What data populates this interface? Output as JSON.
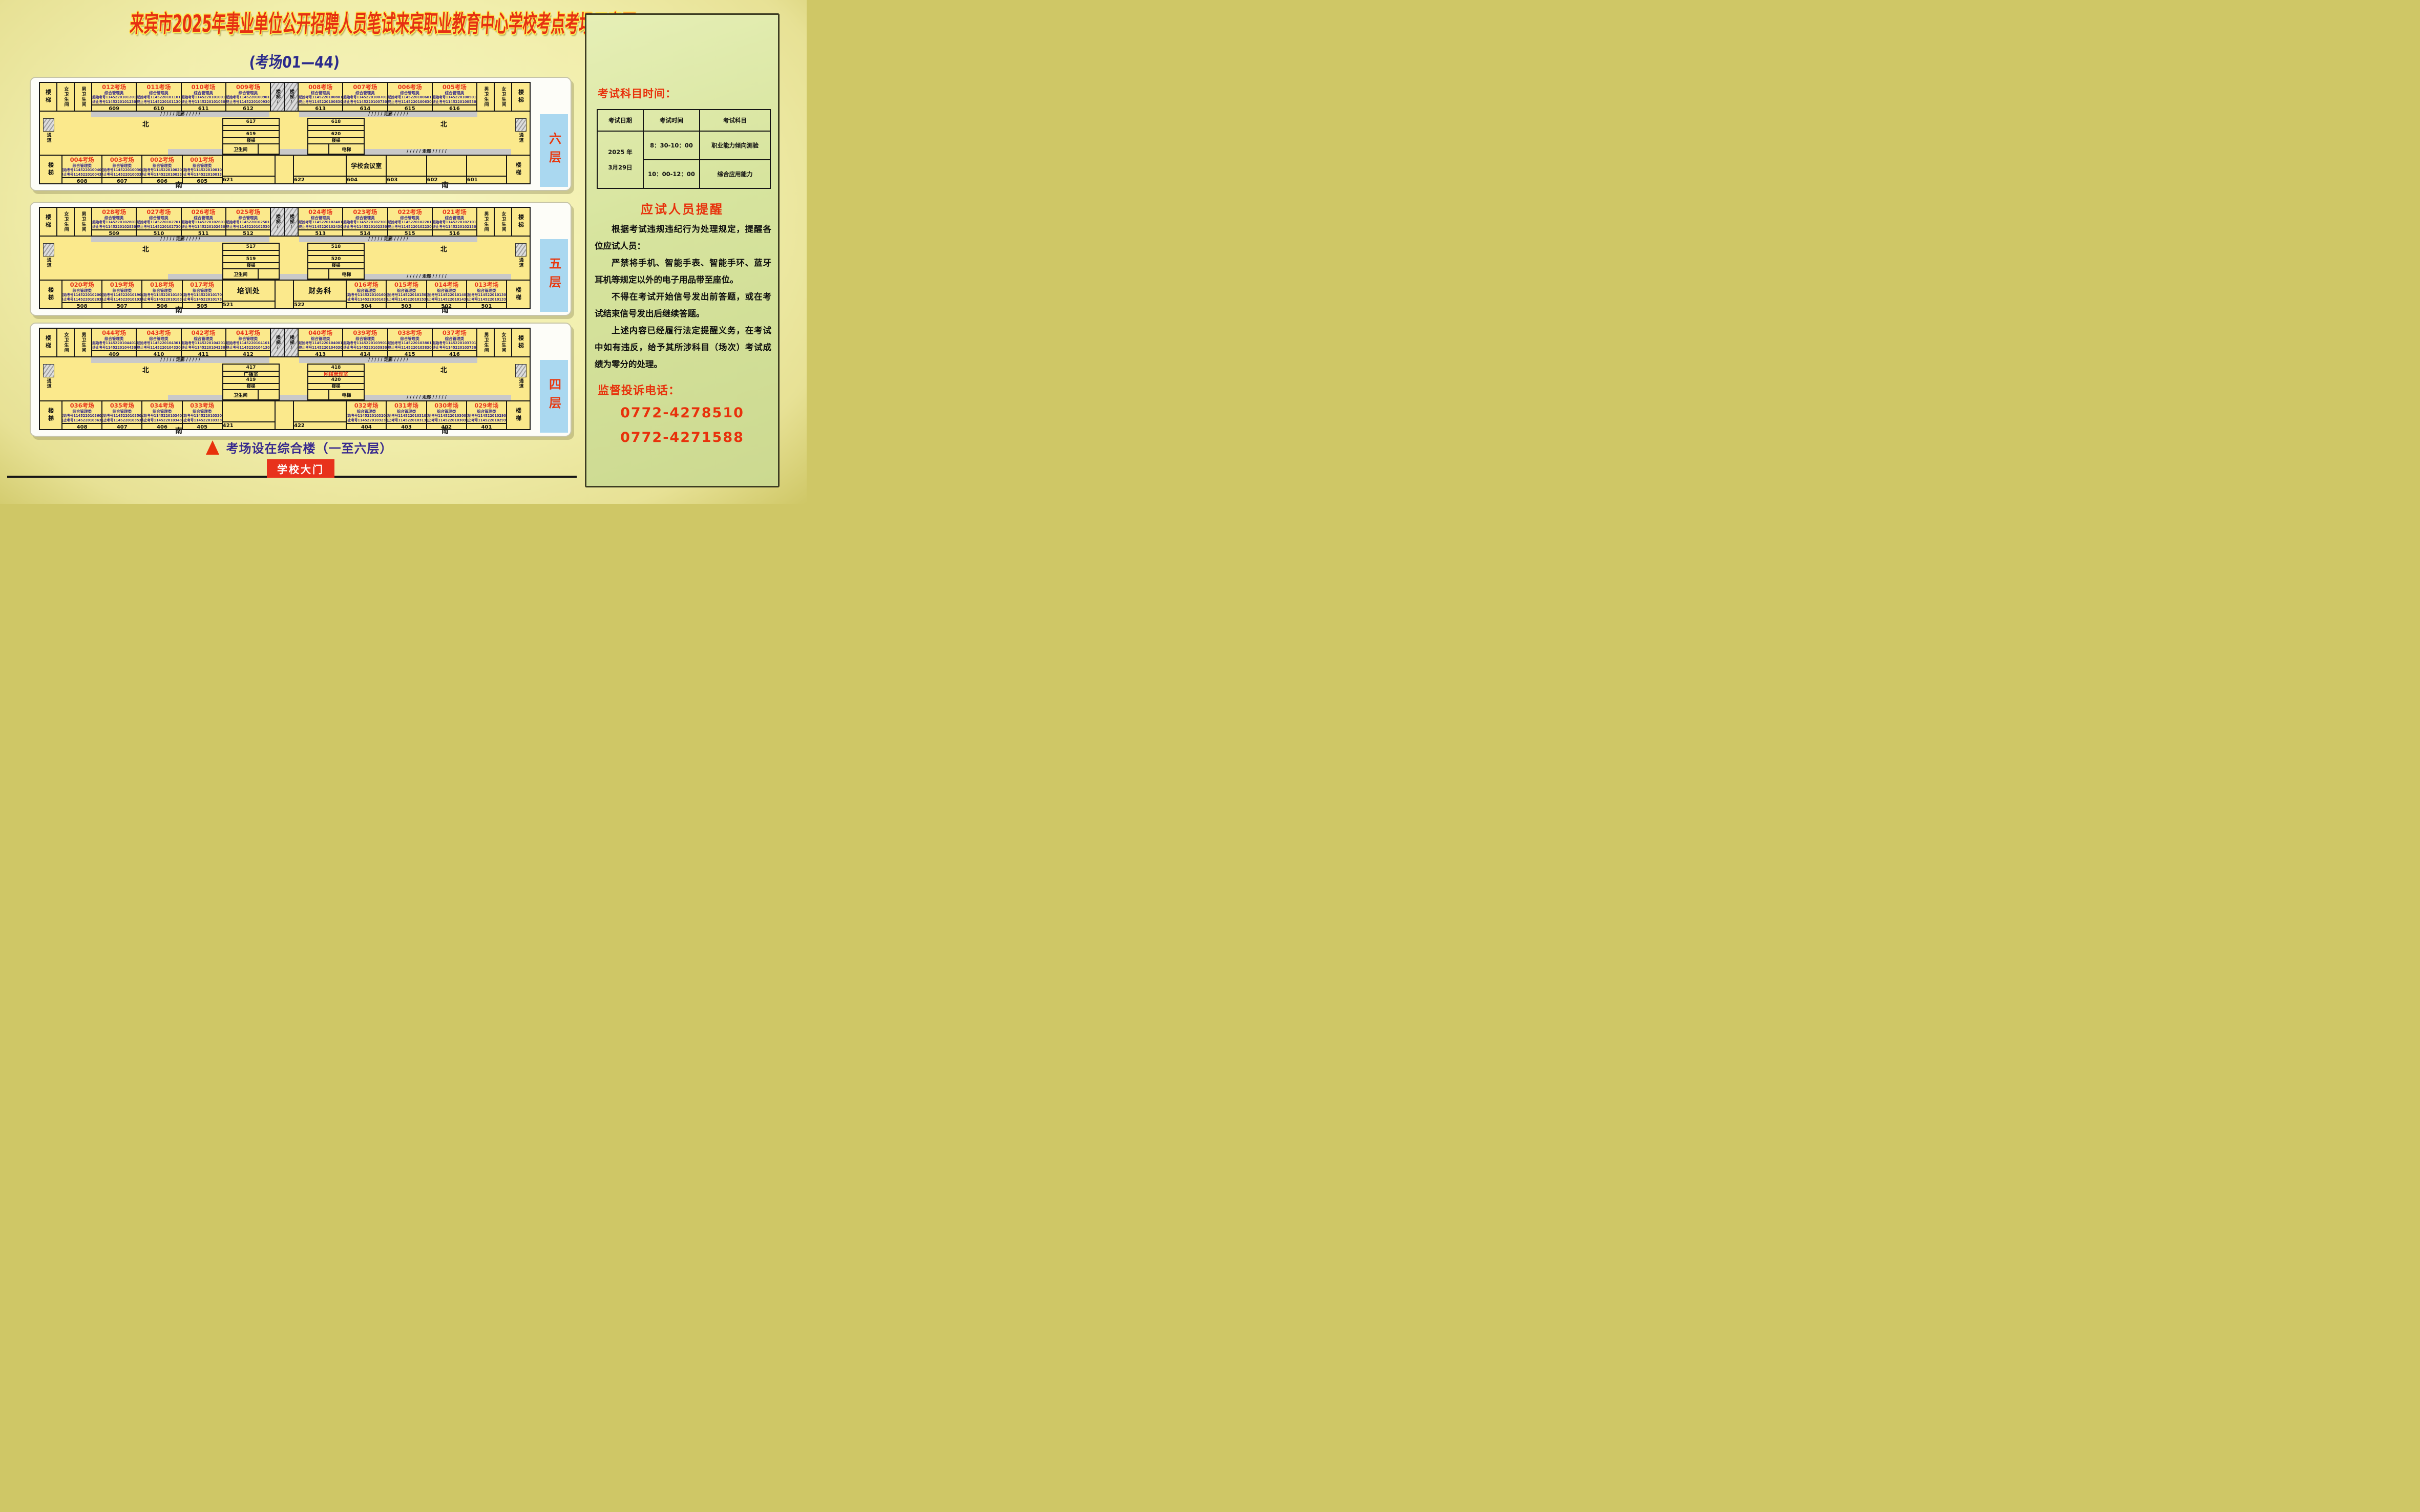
{
  "title": "来宾市2025年事业单位公开招聘人员笔试来宾职业教育中心学校考点考场示意图",
  "subtitle": "(考场01—44)",
  "labels": {
    "north": "北",
    "south": "南",
    "corridor": "/ / / / / 走廊 / / / / /",
    "passage": "通道",
    "stairs": "楼梯",
    "stairs_hatch": "楼梯/",
    "female_wc": "女卫生间",
    "male_wc": "男卫生间",
    "toilet": "卫生间",
    "elevator": "电梯",
    "category": "综合管理类",
    "start_prefix": "起始考号",
    "end_prefix": "终止考号"
  },
  "colors": {
    "accent_red": "#e8380f",
    "detail_purple": "#35298c",
    "room_yellow": "#fbe98c",
    "floor_bar_blue": "#aad8f0",
    "panel_green": "#d7e49e",
    "corridor_gray": "#c9c9c9",
    "gate_red": "#e8321c",
    "note_purple": "#37298e"
  },
  "floors": [
    {
      "bar": "六层",
      "top_left": [
        {
          "t": "012考场",
          "s": "1145220101201",
          "e": "1145220101230",
          "n": "609"
        },
        {
          "t": "011考场",
          "s": "1145220101101",
          "e": "1145220101130",
          "n": "610"
        },
        {
          "t": "010考场",
          "s": "1145220101001",
          "e": "1145220101030",
          "n": "611"
        },
        {
          "t": "009考场",
          "s": "1145220100901",
          "e": "1145220100930",
          "n": "612"
        }
      ],
      "top_right": [
        {
          "t": "008考场",
          "s": "1145220100801",
          "e": "1145220100830",
          "n": "613"
        },
        {
          "t": "007考场",
          "s": "1145220100701",
          "e": "1145220100730",
          "n": "614"
        },
        {
          "t": "006考场",
          "s": "1145220100601",
          "e": "1145220100630",
          "n": "615"
        },
        {
          "t": "005考场",
          "s": "1145220100501",
          "e": "1145220100530",
          "n": "616"
        }
      ],
      "bottom_left": [
        {
          "t": "004考场",
          "s": "1145220100401",
          "e": "1145220100430",
          "n": "608"
        },
        {
          "t": "003考场",
          "s": "1145220100301",
          "e": "1145220100330",
          "n": "607"
        },
        {
          "t": "002考场",
          "s": "1145220100201",
          "e": "1145220100230",
          "n": "606"
        },
        {
          "t": "001考场",
          "s": "1145220100101",
          "e": "1145220100130",
          "n": "605"
        }
      ],
      "wide_left": {
        "label": "",
        "n": "621"
      },
      "wide_right": {
        "label": "",
        "n": "622"
      },
      "bottom_right": [
        {
          "label": "学校会议室",
          "n": "604"
        },
        {
          "label": "",
          "n": "603"
        },
        {
          "label": "",
          "n": "602"
        },
        {
          "label": "",
          "n": "601"
        }
      ],
      "block_left": {
        "a": "617",
        "mid": "",
        "b": "619",
        "corner": "卫生间"
      },
      "block_right": {
        "a": "618",
        "mid": "",
        "b": "620",
        "corner": "电梯",
        "mid_red": false
      }
    },
    {
      "bar": "五层",
      "top_left": [
        {
          "t": "028考场",
          "s": "1145220102801",
          "e": "1145220102830",
          "n": "509"
        },
        {
          "t": "027考场",
          "s": "1145220102701",
          "e": "1145220102730",
          "n": "510"
        },
        {
          "t": "026考场",
          "s": "1145220102601",
          "e": "1145220102630",
          "n": "511"
        },
        {
          "t": "025考场",
          "s": "1145220102501",
          "e": "1145220102530",
          "n": "512"
        }
      ],
      "top_right": [
        {
          "t": "024考场",
          "s": "1145220102401",
          "e": "1145220102430",
          "n": "513"
        },
        {
          "t": "023考场",
          "s": "1145220102301",
          "e": "1145220102330",
          "n": "514"
        },
        {
          "t": "022考场",
          "s": "1145220102201",
          "e": "1145220102230",
          "n": "515"
        },
        {
          "t": "021考场",
          "s": "1145220102101",
          "e": "1145220102130",
          "n": "516"
        }
      ],
      "bottom_left": [
        {
          "t": "020考场",
          "s": "1145220102001",
          "e": "1145220102030",
          "n": "508"
        },
        {
          "t": "019考场",
          "s": "1145220101901",
          "e": "1145220101930",
          "n": "507"
        },
        {
          "t": "018考场",
          "s": "1145220101801",
          "e": "1145220101830",
          "n": "506"
        },
        {
          "t": "017考场",
          "s": "1145220101701",
          "e": "1145220101730",
          "n": "505"
        }
      ],
      "wide_left": {
        "label": "培训处",
        "n": "521"
      },
      "wide_right": {
        "label": "财务科",
        "n": "522"
      },
      "bottom_right": [
        {
          "t": "016考场",
          "s": "1145220101601",
          "e": "1145220101630",
          "n": "504"
        },
        {
          "t": "015考场",
          "s": "1145220101501",
          "e": "1145220101530",
          "n": "503"
        },
        {
          "t": "014考场",
          "s": "1145220101401",
          "e": "1145220101430",
          "n": "502"
        },
        {
          "t": "013考场",
          "s": "1145220101301",
          "e": "1145220101330",
          "n": "501"
        }
      ],
      "block_left": {
        "a": "517",
        "mid": "",
        "b": "519",
        "corner": "卫生间"
      },
      "block_right": {
        "a": "518",
        "mid": "",
        "b": "520",
        "corner": "电梯",
        "mid_red": false
      }
    },
    {
      "bar": "四层",
      "top_left": [
        {
          "t": "044考场",
          "s": "1145220104401",
          "e": "1145220104430",
          "n": "409"
        },
        {
          "t": "043考场",
          "s": "1145220104301",
          "e": "1145220104330",
          "n": "410"
        },
        {
          "t": "042考场",
          "s": "1145220104201",
          "e": "1145220104230",
          "n": "411"
        },
        {
          "t": "041考场",
          "s": "1145220104101",
          "e": "1145220104130",
          "n": "412"
        }
      ],
      "top_right": [
        {
          "t": "040考场",
          "s": "1145220104001",
          "e": "1145220104030",
          "n": "413"
        },
        {
          "t": "039考场",
          "s": "1145220103901",
          "e": "1145220103930",
          "n": "414"
        },
        {
          "t": "038考场",
          "s": "1145220103801",
          "e": "1145220103830",
          "n": "415"
        },
        {
          "t": "037考场",
          "s": "1145220103701",
          "e": "1145220103730",
          "n": "416"
        }
      ],
      "bottom_left": [
        {
          "t": "036考场",
          "s": "1145220103601",
          "e": "1145220103630",
          "n": "408"
        },
        {
          "t": "035考场",
          "s": "1145220103501",
          "e": "1145220103530",
          "n": "407"
        },
        {
          "t": "034考场",
          "s": "1145220103401",
          "e": "1145220103430",
          "n": "406"
        },
        {
          "t": "033考场",
          "s": "1145220103301",
          "e": "1145220103330",
          "n": "405"
        }
      ],
      "wide_left": {
        "label": "",
        "n": "421"
      },
      "wide_right": {
        "label": "",
        "n": "422"
      },
      "bottom_right": [
        {
          "t": "032考场",
          "s": "1145220103201",
          "e": "1145220103230",
          "n": "404"
        },
        {
          "t": "031考场",
          "s": "1145220103101",
          "e": "1145220103130",
          "n": "403"
        },
        {
          "t": "030考场",
          "s": "1145220103001",
          "e": "1145220103030",
          "n": "402"
        },
        {
          "t": "029考场",
          "s": "1145220102901",
          "e": "1145220102930",
          "n": "401"
        }
      ],
      "block_left": {
        "a": "417",
        "mid": "广播室",
        "b": "419",
        "corner": "卫生间"
      },
      "block_right": {
        "a": "418",
        "mid": "网络管理室",
        "b": "420",
        "corner": "电梯",
        "mid_red": true
      }
    }
  ],
  "panel": {
    "schedule_title": "考试科目时间：",
    "table": {
      "headers": [
        "考试日期",
        "考试时间",
        "考试科目"
      ],
      "date_lines": [
        "2025 年",
        "3月29日"
      ],
      "rows": [
        {
          "time": "8：30-10：00",
          "subject": "职业能力倾向测验"
        },
        {
          "time": "10：00-12：00",
          "subject": "综合应用能力"
        }
      ]
    },
    "reminder_title": "应试人员提醒",
    "paragraphs": [
      "根据考试违规违纪行为处理规定，提醒各位应试人员：",
      "严禁将手机、智能手表、智能手环、蓝牙耳机等规定以外的电子用品带至座位。",
      "不得在考试开始信号发出前答题，或在考试结束信号发出后继续答题。",
      "上述内容已经履行法定提醒义务，在考试中如有违反，给予其所涉科目（场次）考试成绩为零分的处理。"
    ],
    "phone_title": "监督投诉电话：",
    "phones": [
      "0772-4278510",
      "0772-4271588"
    ]
  },
  "footer": {
    "note": "考场设在综合楼（一至六层）",
    "gate": "学校大门"
  }
}
